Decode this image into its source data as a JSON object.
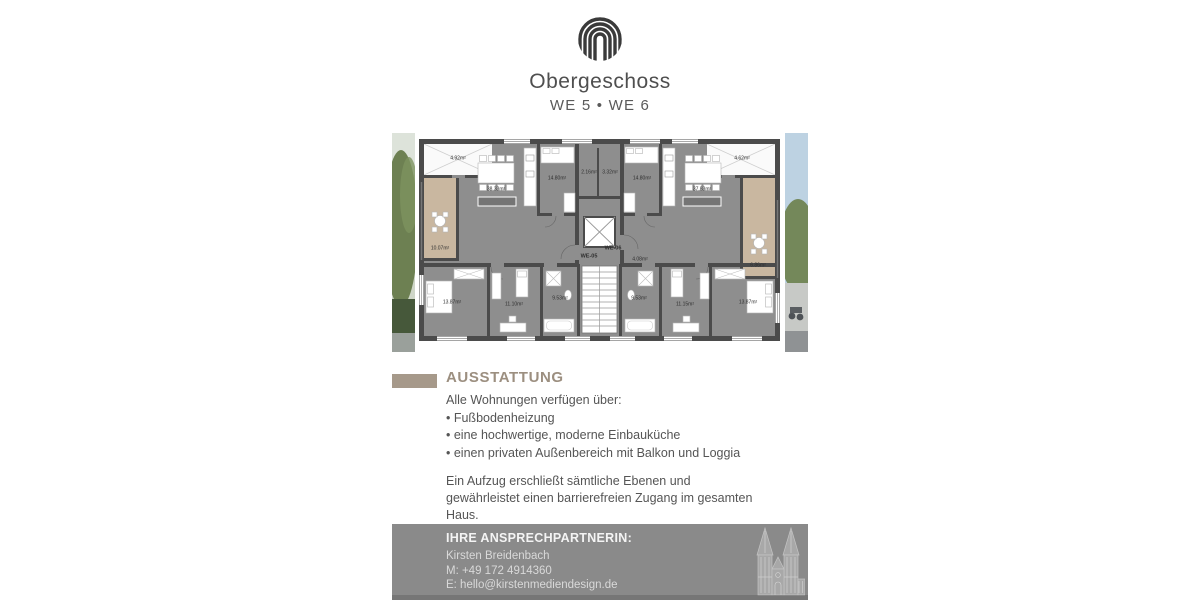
{
  "theme": {
    "accent": "#a6998a",
    "accent-text": "#9c8f80",
    "text": "#555555",
    "title": "#4f4f4f",
    "footer-bg": "#8a8a8a"
  },
  "header": {
    "title": "Obergeschoss",
    "subtitle": "WE 5 • WE 6",
    "logo": "concentric-arches-logo"
  },
  "floorplan": {
    "description": "Grundriss Obergeschoss mit Wohnungen WE-05 und WE-06",
    "labels": [
      {
        "text": "4.92m²",
        "x": 66,
        "y": 26
      },
      {
        "text": "10.07m²",
        "x": 48,
        "y": 116
      },
      {
        "text": "38.33m²",
        "x": 104,
        "y": 57
      },
      {
        "text": "14.80m²",
        "x": 165,
        "y": 46
      },
      {
        "text": "13.87m²",
        "x": 60,
        "y": 170
      },
      {
        "text": "11.10m²",
        "x": 122,
        "y": 172
      },
      {
        "text": "9.53m²",
        "x": 168,
        "y": 166
      },
      {
        "text": "2.16m²",
        "x": 197,
        "y": 40
      },
      {
        "text": "3.32m²",
        "x": 218,
        "y": 40
      },
      {
        "text": "WE-05",
        "x": 197,
        "y": 124,
        "bold": true
      },
      {
        "text": "WE-06",
        "x": 221,
        "y": 116,
        "bold": true
      },
      {
        "text": "4.08m²",
        "x": 248,
        "y": 127
      },
      {
        "text": "14.80m²",
        "x": 250,
        "y": 46
      },
      {
        "text": "37.83m²",
        "x": 310,
        "y": 57
      },
      {
        "text": "4.62m²",
        "x": 350,
        "y": 26
      },
      {
        "text": "6.86m²",
        "x": 366,
        "y": 133
      },
      {
        "text": "13.87m²",
        "x": 356,
        "y": 170
      },
      {
        "text": "11.15m²",
        "x": 293,
        "y": 172
      },
      {
        "text": "9.53m²",
        "x": 247,
        "y": 166
      }
    ]
  },
  "ausstattung": {
    "heading": "AUSSTATTUNG",
    "intro": "Alle Wohnungen verfügen über:",
    "items": [
      "• Fußbodenheizung",
      "• eine hochwertige, moderne Einbauküche",
      "• einen privaten Außenbereich mit Balkon und Loggia"
    ],
    "paragraph": "Ein Aufzug erschließt sämtliche Ebenen und gewährleistet einen barrierefreien Zugang im gesamten Haus."
  },
  "footer": {
    "heading": "IHRE ANSPRECHPARTNERIN:",
    "name": "Kirsten Breidenbach",
    "mobile": "M: +49 172 4914360",
    "email": "E: hello@kirstenmediendesign.de",
    "illustration": "cologne-cathedral"
  }
}
